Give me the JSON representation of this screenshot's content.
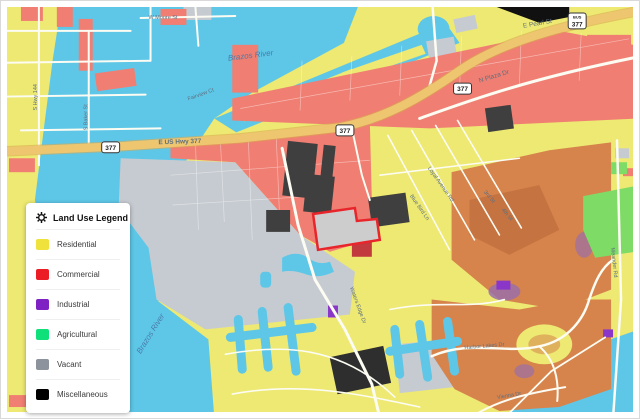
{
  "legend": {
    "title": "Land Use Legend",
    "items": [
      {
        "label": "Residential",
        "color": "#F0E23C"
      },
      {
        "label": "Commercial",
        "color": "#EC1C24"
      },
      {
        "label": "Industrial",
        "color": "#7E22C3"
      },
      {
        "label": "Agricultural",
        "color": "#0FE079"
      },
      {
        "label": "Vacant",
        "color": "#8C939C"
      },
      {
        "label": "Miscellaneous",
        "color": "#000000"
      }
    ]
  },
  "map": {
    "labels": {
      "river_top": "Brazos River",
      "river_bottom": "Brazos River",
      "hwy377": "E US Hwy 377",
      "pearl": "E Pearl St",
      "plaza": "N Plaza Dr",
      "moore": "W Moore St",
      "hwy144": "S Hwy 144",
      "baker": "S Baker St",
      "fairview": "Fairview Ct",
      "loyal": "Loyal Avenue Rd",
      "bluebird": "Blue Bird Ln",
      "third": "3rd St",
      "fourth": "4th St",
      "harbor_lakes": "Harbor Lakes Dr",
      "vienna": "Vienna Dr",
      "meander": "Meander Rd",
      "waters_edge": "Waters Edge Dr",
      "shield": "377",
      "shield_bus": "BUS"
    },
    "colors": {
      "water": "#5EC7E8",
      "land": "#EDE972",
      "commercial": "#F07E72",
      "vacant": "#C6CBD1",
      "golf": "#D6834C",
      "highway": "#EEC66F",
      "selected_outline": "#E8252B"
    }
  }
}
